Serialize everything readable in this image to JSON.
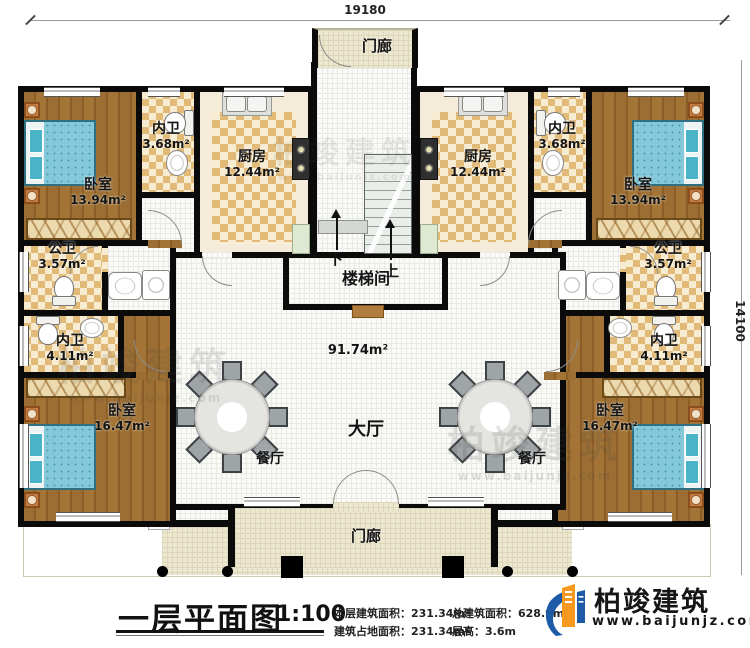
{
  "plan": {
    "dimensions": {
      "width": "19180",
      "height": "14100"
    },
    "rooms": {
      "porch_top": {
        "name": "门廊"
      },
      "bedroom_tl": {
        "name": "卧室",
        "area": "13.94m²"
      },
      "neiwei_tl": {
        "name": "内卫",
        "area": "3.68m²"
      },
      "kitchen_left": {
        "name": "厨房",
        "area": "12.44m²"
      },
      "gongwei_left": {
        "name": "公卫",
        "area": "3.57m²"
      },
      "neiwei_ml": {
        "name": "内卫",
        "area": "4.11m²"
      },
      "bedroom_bl": {
        "name": "卧室",
        "area": "16.47m²"
      },
      "dining_left": {
        "name": "餐厅"
      },
      "stairwell": {
        "name": "楼梯间",
        "down": "下",
        "up": "上"
      },
      "hall": {
        "name": "大厅",
        "area": "91.74m²"
      },
      "kitchen_right": {
        "name": "厨房",
        "area": "12.44m²"
      },
      "neiwei_tr": {
        "name": "内卫",
        "area": "3.68m²"
      },
      "bedroom_tr": {
        "name": "卧室",
        "area": "13.94m²"
      },
      "gongwei_right": {
        "name": "公卫",
        "area": "3.57m²"
      },
      "neiwei_mr": {
        "name": "内卫",
        "area": "4.11m²"
      },
      "bedroom_br": {
        "name": "卧室",
        "area": "16.47m²"
      },
      "dining_right": {
        "name": "餐厅"
      },
      "porch_bottom": {
        "name": "门廊"
      }
    }
  },
  "footer": {
    "title": "一层平面图",
    "scale": "1:100",
    "stats": [
      {
        "label": "本层建筑面积：",
        "value": "231.34m²"
      },
      {
        "label": "总建筑面积：",
        "value": "628.9m²"
      },
      {
        "label": "建筑占地面积：",
        "value": "231.34m²"
      },
      {
        "label": "层高：",
        "value": "3.6m"
      }
    ]
  },
  "brand": {
    "name": "柏竣建筑",
    "url": "www.baijunjz.com"
  },
  "colors": {
    "wall": "#0b0b0b",
    "wood": "#96682e",
    "checker": "#e2ba77",
    "porch": "#ece7d0",
    "brand_blue": "#1e5ba6",
    "brand_orange": "#f6991e"
  }
}
